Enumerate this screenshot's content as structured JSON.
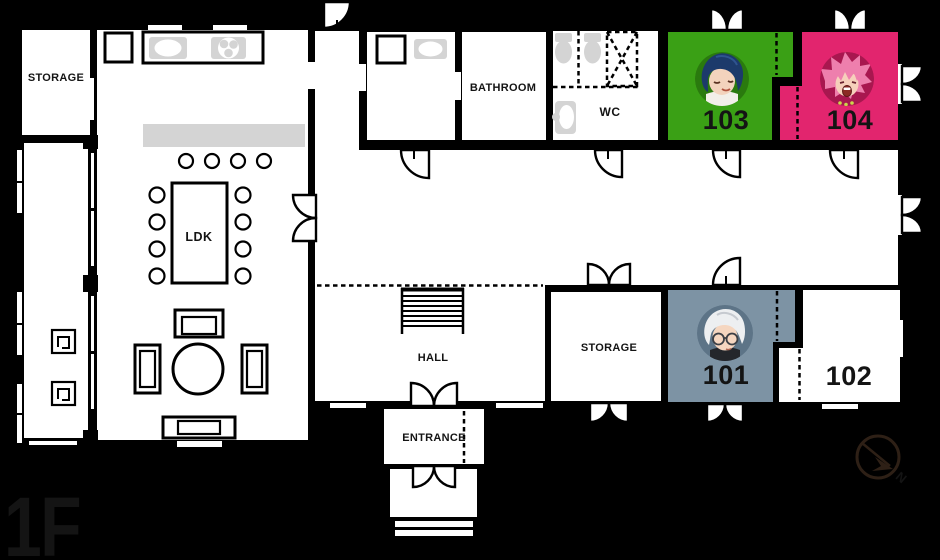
{
  "floor_plan": {
    "floor_label": "1F",
    "floor_label_color": "#e8520e",
    "wall_color": "#000000",
    "floor_color": "#ffffff",
    "furniture_gray": "#d4d4d4",
    "compass": {
      "north_label": "N"
    },
    "labels": {
      "storage_top_left": "STORAGE",
      "ldk": "LDK",
      "bathroom": "BATHROOM",
      "wc": "WC",
      "hall": "HALL",
      "storage_center": "STORAGE",
      "entrance": "ENTRANCE"
    },
    "rooms": {
      "room_101": {
        "number": "101",
        "color": "#7d93a4",
        "avatar_bg": "#5d7487",
        "avatar": "silver-haired-tenant-with-glasses",
        "occupied": true
      },
      "room_102": {
        "number": "102",
        "color": "#ffffff",
        "occupied": false
      },
      "room_103": {
        "number": "103",
        "color": "#3aa015",
        "avatar_bg": "#2a7a0e",
        "avatar": "blue-haired-tenant",
        "occupied": true
      },
      "room_104": {
        "number": "104",
        "color": "#e2256e",
        "avatar_bg": "#a8174f",
        "avatar": "pink-haired-tenant",
        "occupied": true
      }
    }
  }
}
